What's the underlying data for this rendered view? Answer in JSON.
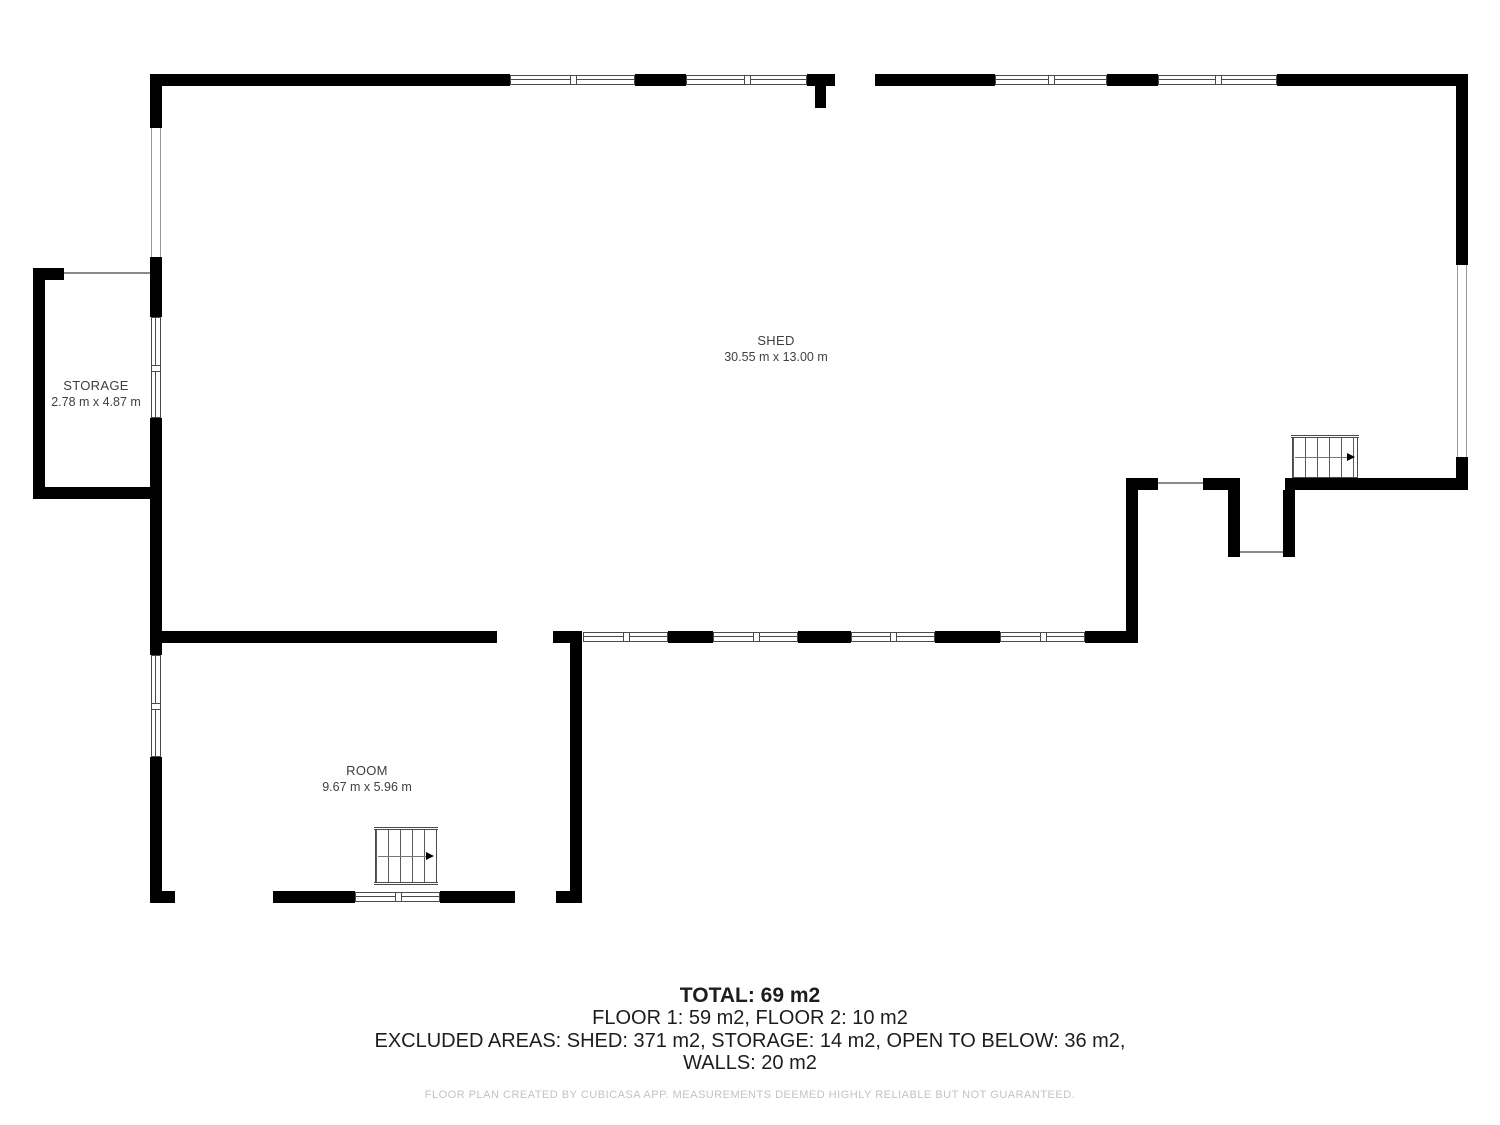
{
  "floorplan": {
    "rooms": [
      {
        "name": "SHED",
        "dimensions": "30.55 m x 13.00 m"
      },
      {
        "name": "STORAGE",
        "dimensions": "2.78 m x 4.87 m"
      },
      {
        "name": "ROOM",
        "dimensions": "9.67 m x 5.96 m"
      }
    ],
    "summary": {
      "total": "TOTAL: 69 m2",
      "floors": "FLOOR 1: 59 m2, FLOOR 2: 10 m2",
      "excluded_areas": "EXCLUDED AREAS: SHED: 371 m2, STORAGE: 14 m2, OPEN TO BELOW: 36 m2,",
      "walls": "WALLS: 20 m2"
    },
    "disclaimer": "FLOOR PLAN CREATED BY CUBICASA APP. MEASUREMENTS DEEMED HIGHLY RELIABLE BUT NOT GUARANTEED.",
    "colors": {
      "wall": "#000000",
      "label_text": "#3f3f3f",
      "summary_text": "#1d1d1d",
      "disclaimer_text": "#c3c3c3"
    }
  }
}
